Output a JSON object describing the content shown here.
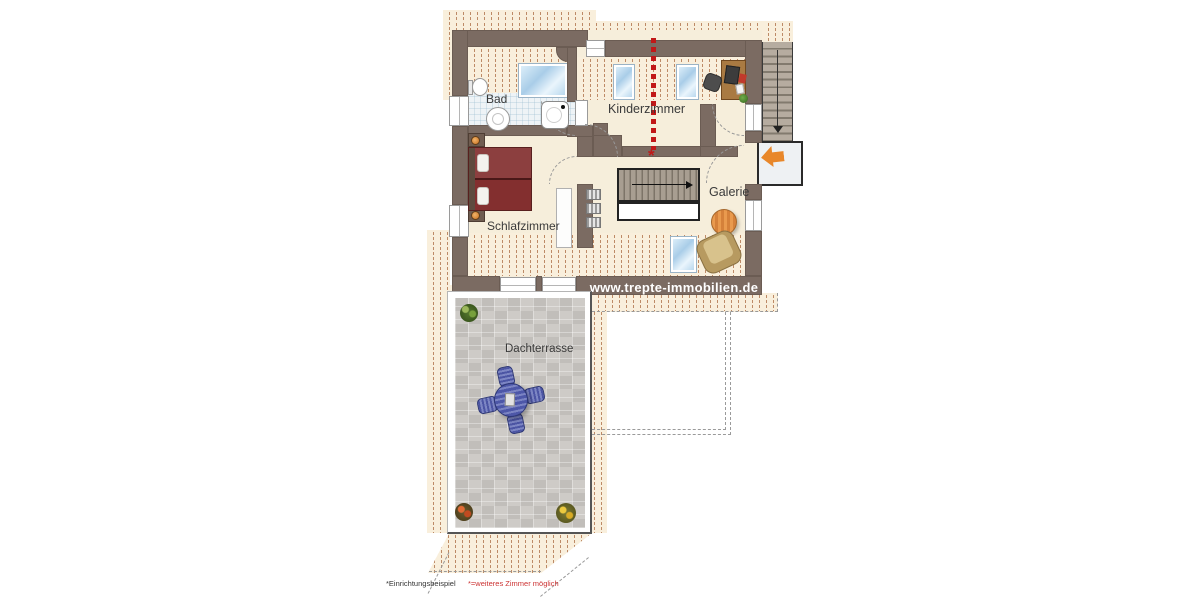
{
  "plan": {
    "labels": {
      "bathroom": "Bad",
      "kids_room": "Kinderzimmer",
      "bedroom": "Schlafzimmer",
      "gallery": "Galerie",
      "roof_terrace": "Dachterrasse"
    },
    "watermark": "www.trepte-immobilien.de",
    "divider_marker": "*",
    "footnotes": {
      "example": "*Einrichtungsbeispiel",
      "extra_room": "*=weiteres Zimmer möglich"
    },
    "colors": {
      "wall": "#7b6b62",
      "floor": "#f6eedb",
      "hatch_bg": "#f9efdc",
      "hatch_line": "#bd8a66",
      "accent_red": "#c11818",
      "arrow_orange": "#e8872a",
      "terrace_tile": "#c9c6c1",
      "skylight_blue": "#a9cde8",
      "bed_red": "#832f2f",
      "table_orange": "#e2913f",
      "terrace_furniture_blue": "#4c55a4"
    }
  }
}
